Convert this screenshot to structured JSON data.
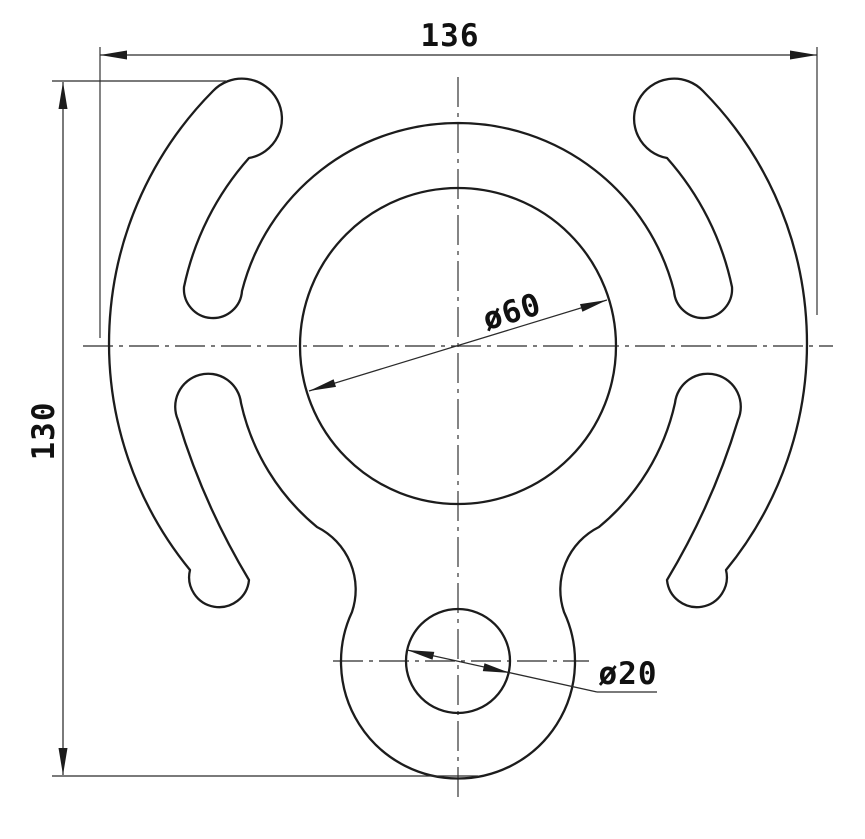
{
  "drawing": {
    "type": "engineering-part-drawing",
    "view": "front view, symmetric rigging-plate-style part with two hooked ears, central bore, and bottom eye",
    "colors": {
      "background": "#ffffff",
      "line": "#1c1c1c"
    },
    "dimensions": {
      "overall_width": "136",
      "overall_height": "130",
      "bore_diameter": "ø60",
      "eye_hole_diameter": "ø20"
    }
  }
}
